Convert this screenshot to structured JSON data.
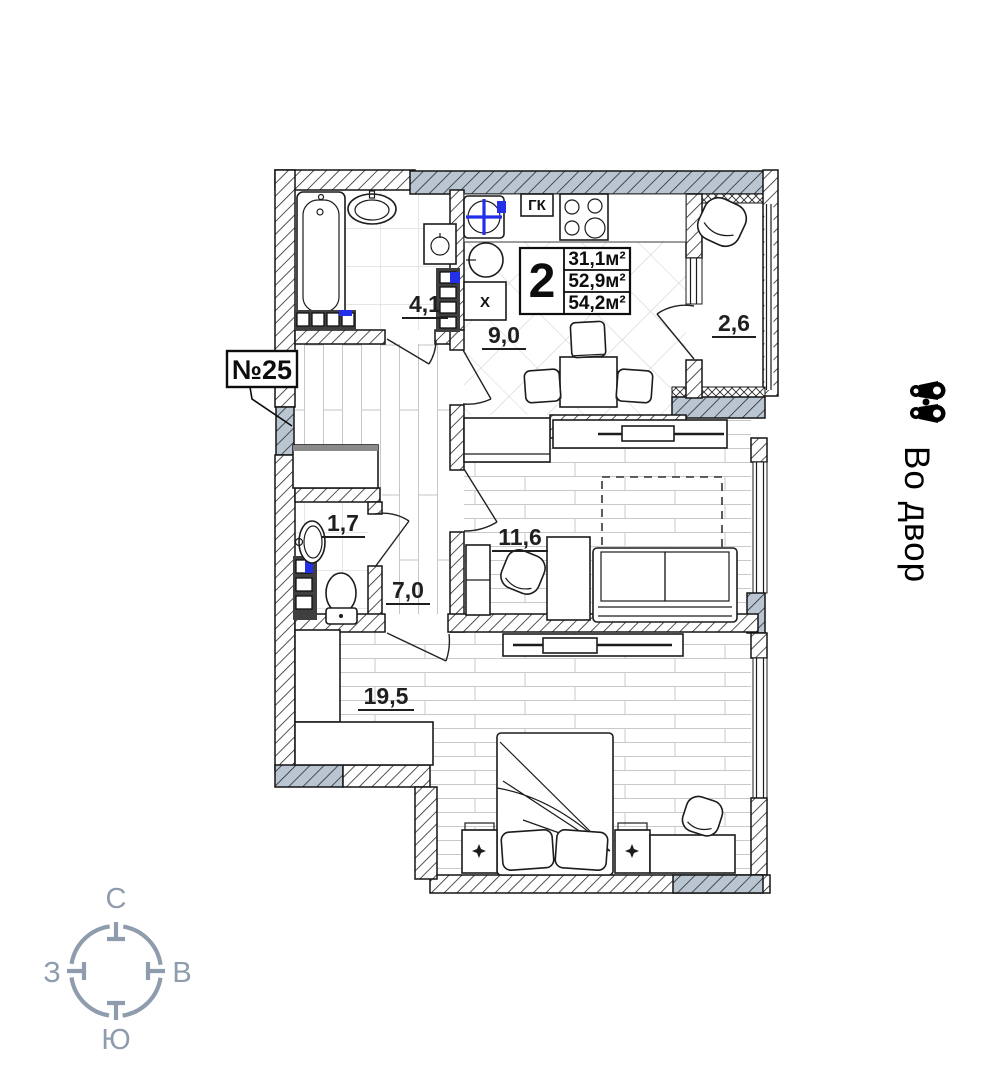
{
  "plan": {
    "apartment_number": "№25",
    "summary": {
      "rooms_count": "2",
      "living_area": "31,1м²",
      "apartment_area": "52,9м²",
      "total_area": "54,2м²"
    },
    "areas": {
      "bathroom": "4,1",
      "kitchen": "9,0",
      "balcony": "2,6",
      "wc": "1,7",
      "hall": "7,0",
      "living": "11,6",
      "bedroom": "19,5"
    },
    "labels": {
      "gk": "ГК",
      "fridge": "Х"
    },
    "view_label": "Во двор",
    "compass": {
      "north": "С",
      "south": "Ю",
      "west": "З",
      "east": "В"
    },
    "colors": {
      "wall_gray": "#b9c6d2",
      "marker_blue": "#2330e8",
      "compass_gray": "#8f9cad"
    }
  }
}
